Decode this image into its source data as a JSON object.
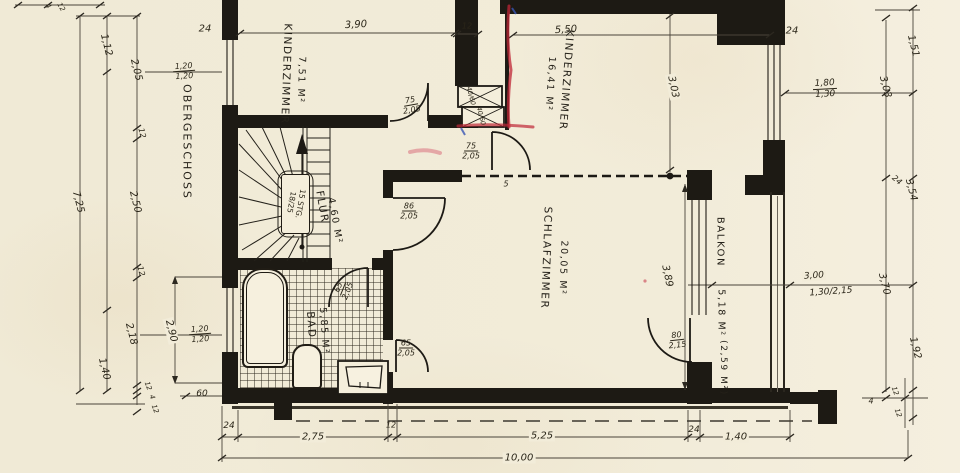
{
  "title": {
    "floor": "OBERGESCHOSS"
  },
  "rooms": {
    "kz1": {
      "name": "KINDERZIMMER",
      "area": "7,51 M²"
    },
    "kz2": {
      "name": "KINDERZIMMER",
      "area": "16,41 M²"
    },
    "sz": {
      "name": "SCHLAFZIMMER",
      "area": "20,05 M²"
    },
    "flur": {
      "name": "FLUR",
      "area": "4,60 M²"
    },
    "bad": {
      "name": "BAD",
      "area": "5,85 M²"
    },
    "balkon": {
      "name": "BALKON",
      "area": "5,18 M²",
      "area_secondary": "(2,59 M²)"
    }
  },
  "stairs": {
    "line1": "15 STG.",
    "line2": "18/25"
  },
  "doors": {
    "kz1_door": {
      "w": "75",
      "h": "2,05"
    },
    "kz2_door": {
      "w": "75",
      "h": "2,05"
    },
    "sz_door": {
      "w": "86",
      "h": "2,05"
    },
    "bad_door": {
      "w": "65",
      "h": "2,05"
    },
    "bad_sz_door": {
      "w": "65",
      "h": "2,05"
    },
    "balkon_door": {
      "w": "80",
      "h": "2,15"
    }
  },
  "windows": {
    "left_upper": {
      "w": "1,20",
      "h": "1,20"
    },
    "left_lower": {
      "w": "1,20",
      "h": "1,20"
    },
    "right_kz2": {
      "w": "1,80",
      "h": "1,30"
    },
    "balkon_opening": {
      "total": "3,00",
      "size": "1,30/2,15"
    }
  },
  "shaft": {
    "box1": "40/60",
    "box2": "40/60"
  },
  "dims": {
    "left": {
      "total": "7,25",
      "a": "1,12",
      "b": "2,05",
      "c": "12",
      "d": "2,50",
      "e": "12",
      "f": "2,18",
      "g": "1,40",
      "window": "2,90",
      "plinth": "60",
      "edge_top_a": "4",
      "edge_top_b": "12",
      "edge_bot_a": "12",
      "edge_bot_b": "4",
      "edge_bot_c": "12"
    },
    "top": {
      "wall_left": "24",
      "kz1": "3,90",
      "shaft": "12",
      "kz2": "5,50",
      "wall_right": "24"
    },
    "right": {
      "inner_a": "3,03",
      "inner_b": "3,70",
      "outer_a": "1,51",
      "outer_b": "3,54",
      "outer_c": "1,92",
      "wall": "24",
      "edge_a": "4",
      "edge_b": "12",
      "edge_c": "12"
    },
    "bottom": {
      "wall_left": "24",
      "a": "2,75",
      "b": "12",
      "c": "5,25",
      "wall_right": "24",
      "d": "1,40",
      "total": "10,00"
    },
    "interior": {
      "kz2_depth": "3,03",
      "sz_depth": "3,89",
      "partition": "5"
    }
  },
  "colors": {
    "ink": "#1d1a14",
    "paper": "#f2ecd9",
    "marker_red": "#bf2636",
    "marker_blue": "#3a56b4"
  }
}
